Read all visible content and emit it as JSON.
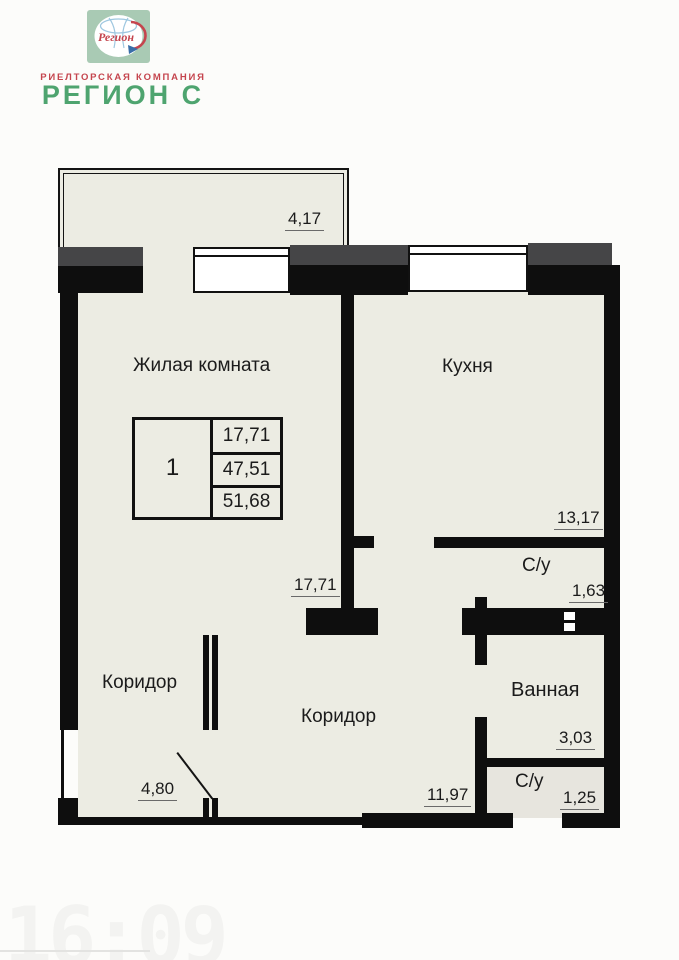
{
  "brand": {
    "logo_word": "Регион",
    "tagline": "РИЕЛТОРСКАЯ КОМПАНИЯ",
    "company_name": "РЕГИОН С"
  },
  "floorplan": {
    "balcony": {
      "dim": "4,17"
    },
    "living_room": {
      "label": "Жилая комната",
      "dim": "17,71"
    },
    "kitchen": {
      "label": "Кухня",
      "dim": "13,17"
    },
    "wc_upper": {
      "label": "С/у",
      "dim": "1,63"
    },
    "bathroom": {
      "label": "Ванная",
      "dim": "3,03"
    },
    "wc_lower": {
      "label": "С/у",
      "dim": "1,25"
    },
    "corridor_left": {
      "label": "Коридор",
      "dim": "4,80"
    },
    "corridor_main": {
      "label": "Коридор",
      "dim": "11,97"
    },
    "info_table": {
      "room_count": "1",
      "living_area": "17,71",
      "total_area": "47,51",
      "full_area": "51,68"
    }
  },
  "watermark": "16:09",
  "colors": {
    "brand_green": "#4ea46f",
    "brand_red": "#c5454e",
    "logo_square": "#a9cab4",
    "logo_blue": "#9ec7e0",
    "wall": "#0e0e0e",
    "slab_gray": "#454547",
    "room_fill": "#ecece3"
  }
}
